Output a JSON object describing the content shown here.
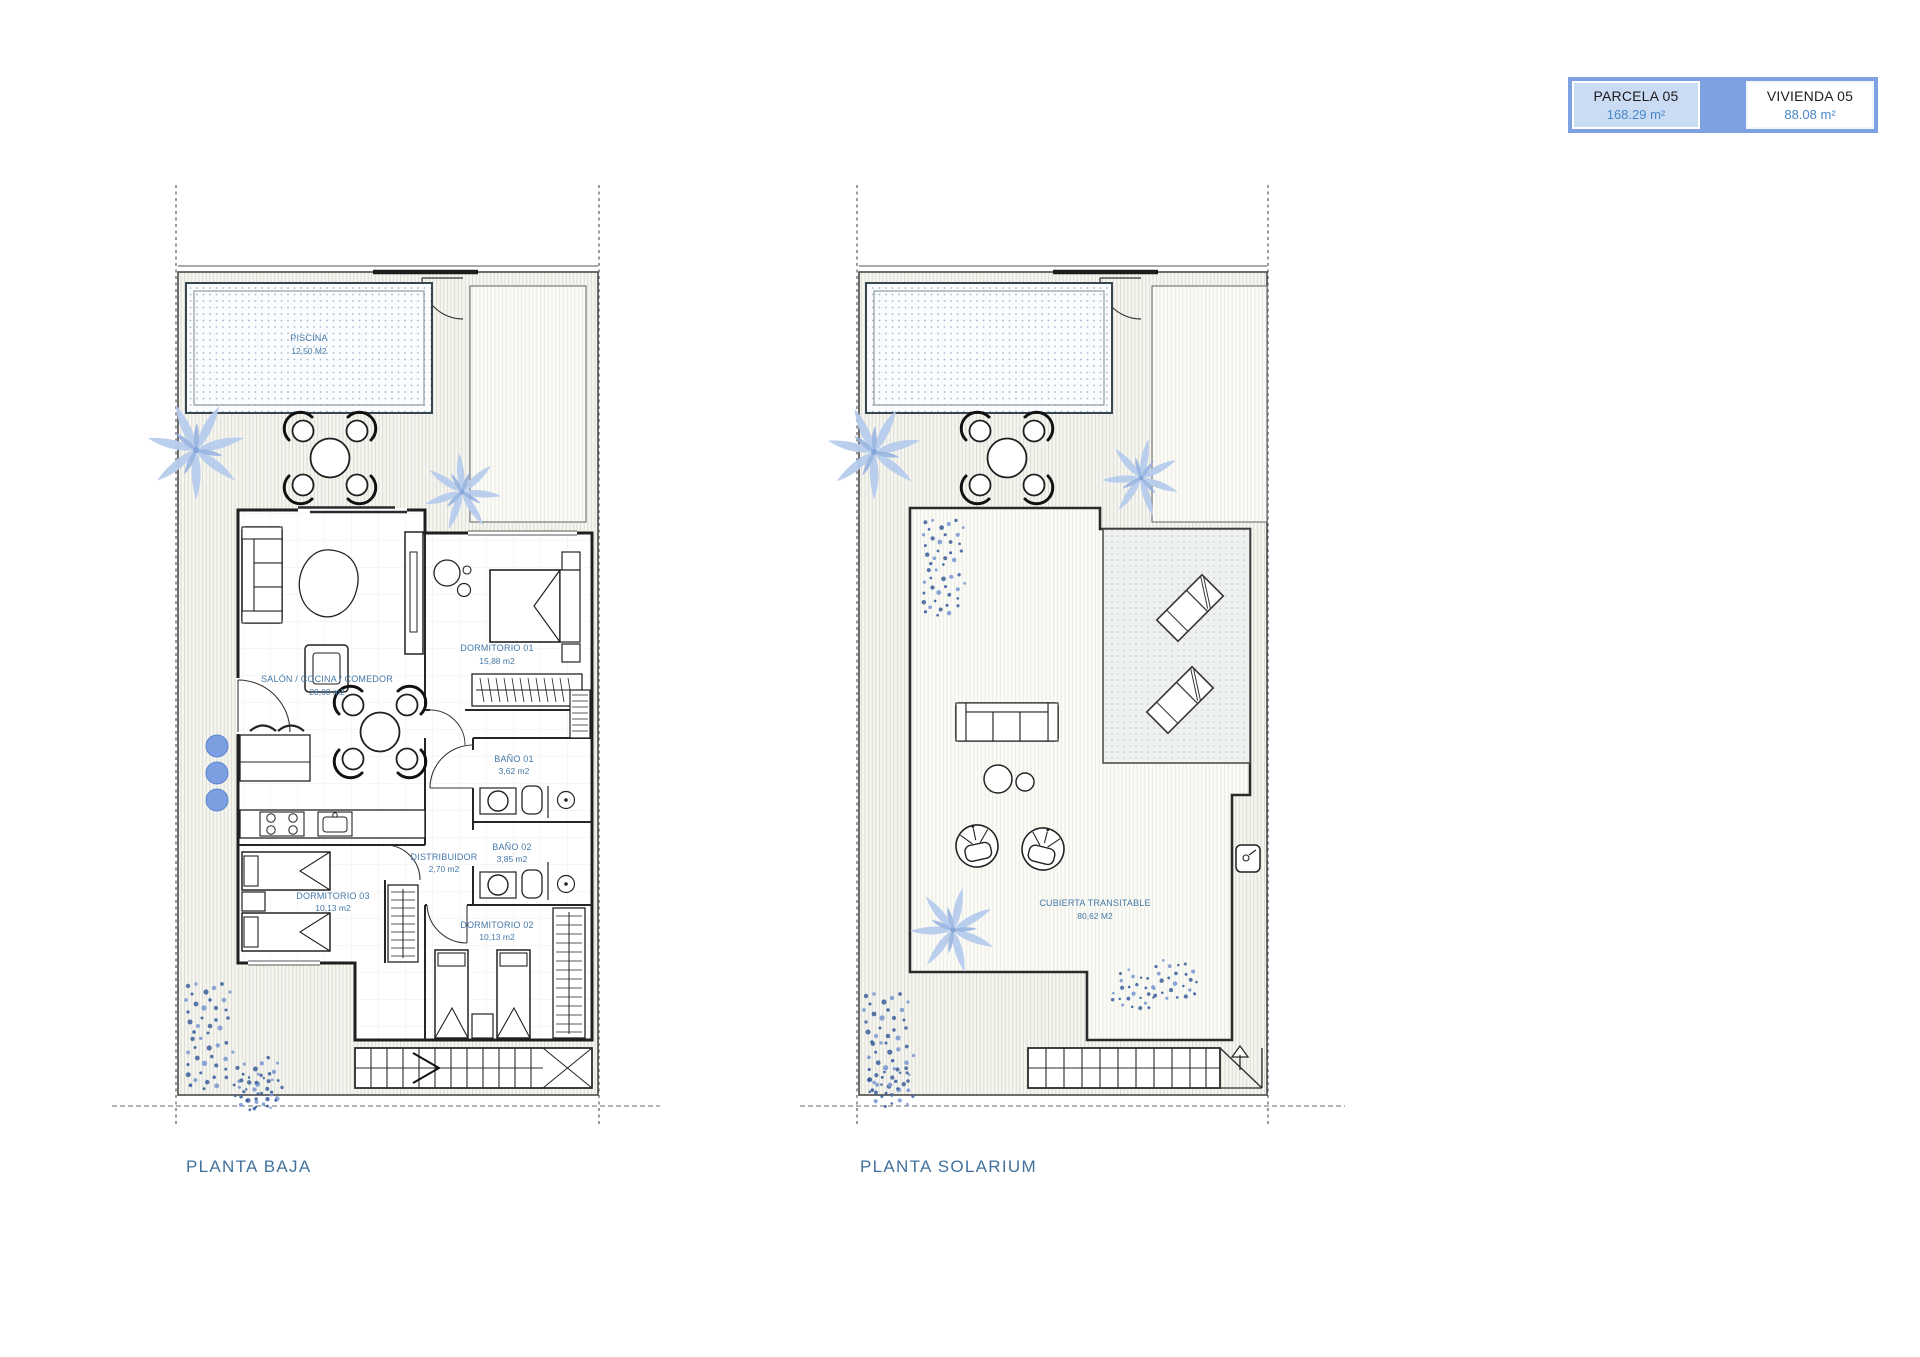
{
  "legend": {
    "parcela_label": "PARCELA 05",
    "parcela_area": "168.29 m²",
    "vivienda_label": "VIVIENDA 05",
    "vivienda_area": "88.08 m²"
  },
  "plans": {
    "planta_baja": {
      "title": "PLANTA BAJA",
      "rooms": [
        {
          "name": "PISCINA",
          "area": "12,50 M2"
        },
        {
          "name": "SALÓN / COCINA / COMEDOR",
          "area": "28,00 m2"
        },
        {
          "name": "DORMITORIO 01",
          "area": "15,88 m2"
        },
        {
          "name": "BAÑO 01",
          "area": "3,62 m2"
        },
        {
          "name": "DISTRIBUIDOR",
          "area": "2,70 m2"
        },
        {
          "name": "BAÑO 02",
          "area": "3,85 m2"
        },
        {
          "name": "DORMITORIO 03",
          "area": "10,13 m2"
        },
        {
          "name": "DORMITORIO 02",
          "area": "10,13 m2"
        }
      ]
    },
    "planta_solarium": {
      "title": "PLANTA SOLARIUM",
      "rooms": [
        {
          "name": "CUBIERTA TRANSITABLE",
          "area": "80,62 M2"
        }
      ]
    }
  },
  "colors": {
    "room_label_text": "#4579a8",
    "plan_title_text": "#41719c",
    "legend_border": "#7ea1e2",
    "legend_parcela_bg": "#c9dcf4",
    "legend_value_text": "#4a86c8",
    "vegetation_blue": "#b7cced",
    "flower_blue": "#4e74b8",
    "pool_dot": "#a4b8cc"
  }
}
